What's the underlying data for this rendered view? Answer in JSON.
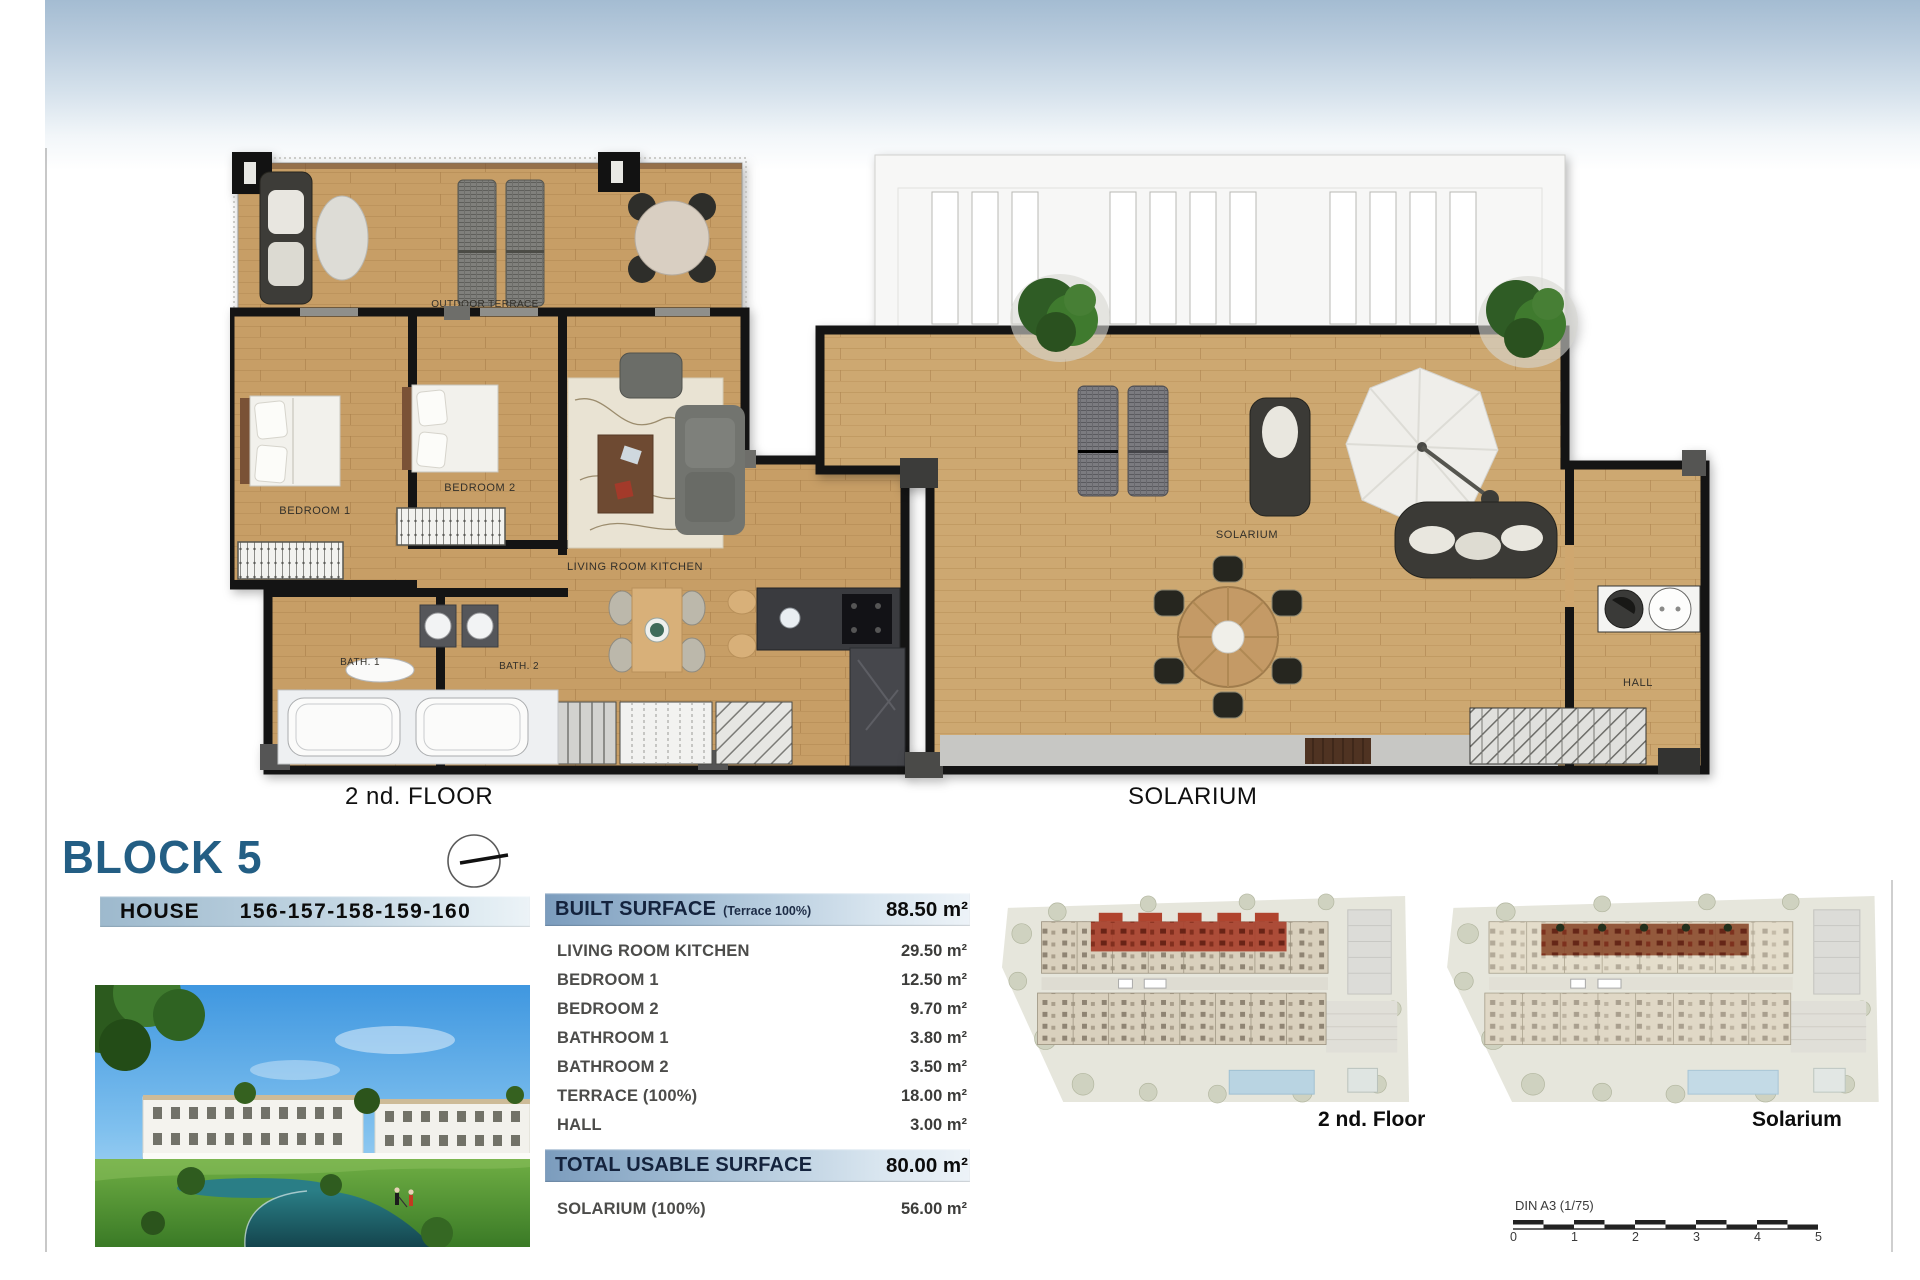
{
  "header": {
    "block_title": "BLOCK 5",
    "house_label": "HOUSE",
    "house_numbers": "156-157-158-159-160"
  },
  "floor_plan": {
    "title": "2 nd. FLOOR",
    "rooms": {
      "outdoor_terrace": "OUTDOOR TERRACE",
      "bedroom1": "BEDROOM 1",
      "bedroom2": "BEDROOM 2",
      "living_room_kitchen": "LIVING ROOM KITCHEN",
      "bath1": "BATH. 1",
      "bath2": "BATH. 2"
    }
  },
  "solarium_plan": {
    "title": "SOLARIUM",
    "rooms": {
      "solarium": "SOLARIUM",
      "hall": "HALL"
    }
  },
  "surface_table": {
    "built": {
      "label": "BUILT SURFACE",
      "note": "(Terrace 100%)",
      "value": "88.50 m²"
    },
    "rows": [
      {
        "label": "LIVING ROOM KITCHEN",
        "value": "29.50 m²"
      },
      {
        "label": "BEDROOM 1",
        "value": "12.50 m²"
      },
      {
        "label": "BEDROOM 2",
        "value": "9.70 m²"
      },
      {
        "label": "BATHROOM 1",
        "value": "3.80 m²"
      },
      {
        "label": "BATHROOM 2",
        "value": "3.50 m²"
      },
      {
        "label": "TERRACE (100%)",
        "value": "18.00 m²"
      },
      {
        "label": "HALL",
        "value": "3.00 m²"
      }
    ],
    "total": {
      "label": "TOTAL USABLE SURFACE",
      "value": "80.00 m²"
    },
    "solarium": {
      "label": "SOLARIUM (100%)",
      "value": "56.00 m²"
    }
  },
  "site_plans": {
    "floor_label": "2 nd. Floor",
    "solarium_label": "Solarium"
  },
  "scale_bar": {
    "label": "DIN A3 (1/75)",
    "ticks": [
      "0",
      "1",
      "2",
      "3",
      "4",
      "5"
    ]
  },
  "colors": {
    "block_title": "#235e84",
    "bar_blue": "#7b9cbd",
    "wood": "#c79e66",
    "wall": "#141414",
    "site_highlight": "#a8402c"
  }
}
